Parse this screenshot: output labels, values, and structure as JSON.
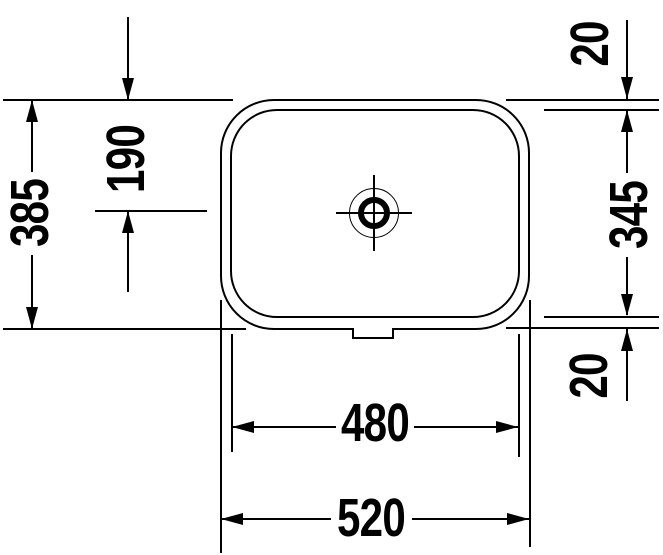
{
  "colors": {
    "line": "#000000",
    "background": "#ffffff"
  },
  "dimensions": {
    "depth_total": "385",
    "depth_to_drain": "190",
    "offset_top": "20",
    "depth_inner": "345",
    "offset_bottom": "20",
    "width_inner": "480",
    "width_total": "520"
  }
}
